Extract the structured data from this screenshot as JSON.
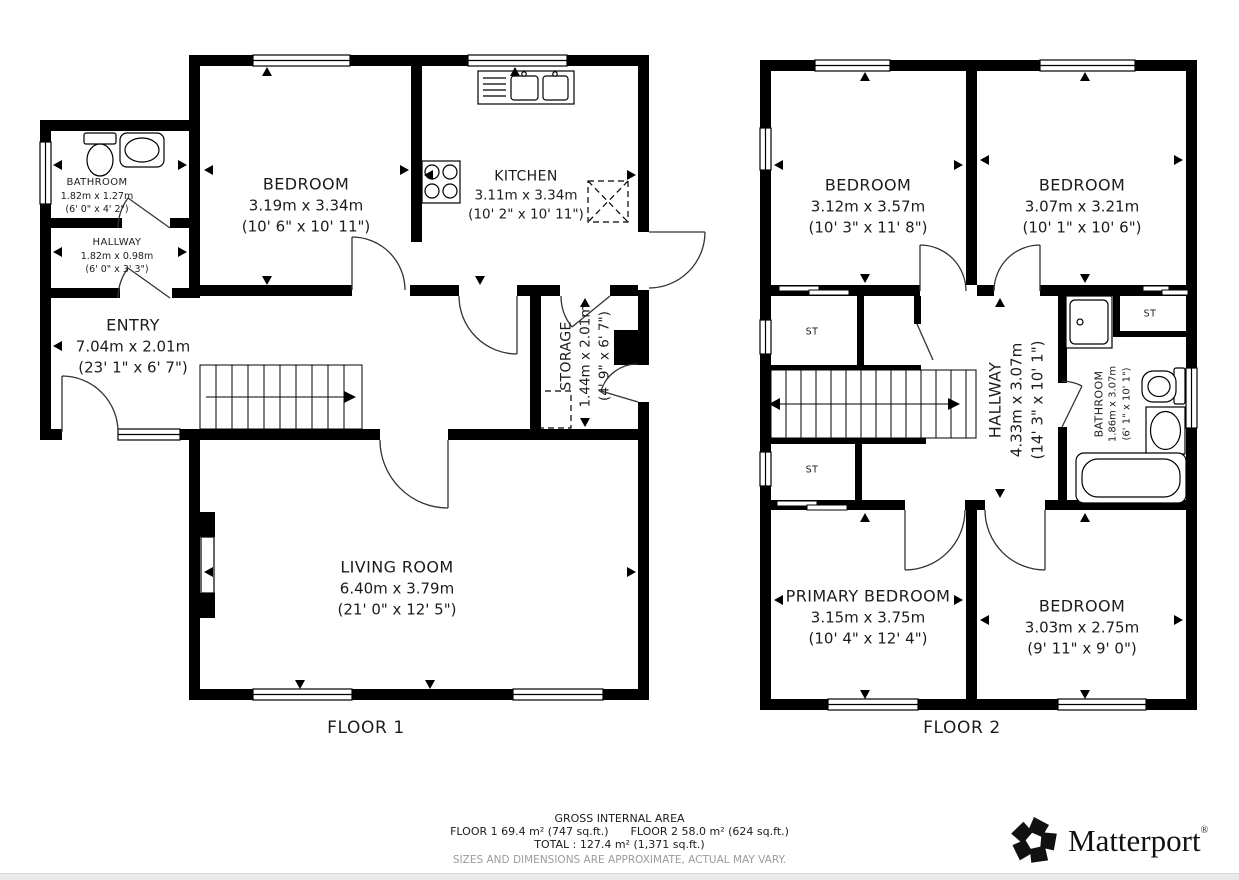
{
  "colors": {
    "wall": "#000000",
    "text": "#1c1c1c",
    "muted_text": "#9b9b9b",
    "footer_bar": "#eaeaea"
  },
  "floor1": {
    "label": "FLOOR 1",
    "rooms": [
      {
        "name": "BATHROOM",
        "metric": "1.82m x 1.27m",
        "imperial": "(6' 0\" x 4' 2\")"
      },
      {
        "name": "HALLWAY",
        "metric": "1.82m x 0.98m",
        "imperial": "(6' 0\" x 3' 3\")"
      },
      {
        "name": "BEDROOM",
        "metric": "3.19m x 3.34m",
        "imperial": "(10' 6\" x 10' 11\")"
      },
      {
        "name": "KITCHEN",
        "metric": "3.11m x 3.34m",
        "imperial": "(10' 2\" x 10' 11\")"
      },
      {
        "name": "ENTRY",
        "metric": "7.04m x 2.01m",
        "imperial": "(23' 1\" x 6' 7\")"
      },
      {
        "name": "STORAGE",
        "metric": "1.44m x 2.01m",
        "imperial": "(4' 9\" x 6' 7\")"
      },
      {
        "name": "LIVING ROOM",
        "metric": "6.40m x 3.79m",
        "imperial": "(21' 0\" x 12' 5\")"
      }
    ]
  },
  "floor2": {
    "label": "FLOOR 2",
    "closet_label": "ST",
    "rooms": [
      {
        "name": "BEDROOM",
        "metric": "3.12m x 3.57m",
        "imperial": "(10' 3\" x 11' 8\")"
      },
      {
        "name": "BEDROOM",
        "metric": "3.07m x 3.21m",
        "imperial": "(10' 1\" x 10' 6\")"
      },
      {
        "name": "HALLWAY",
        "metric": "4.33m x 3.07m",
        "imperial": "(14' 3\" x 10' 1\")"
      },
      {
        "name": "BATHROOM",
        "metric": "1.86m x 3.07m",
        "imperial": "(6' 1\" x 10' 1\")"
      },
      {
        "name": "PRIMARY BEDROOM",
        "metric": "3.15m x 3.75m",
        "imperial": "(10' 4\" x 12' 4\")"
      },
      {
        "name": "BEDROOM",
        "metric": "3.03m x 2.75m",
        "imperial": "(9' 11\" x 9' 0\")"
      }
    ]
  },
  "footer": {
    "gross_title": "GROSS INTERNAL AREA",
    "floor1_area": "FLOOR 1 69.4 m² (747 sq.ft.)",
    "floor2_area": "FLOOR 2 58.0 m² (624 sq.ft.)",
    "total_line": "TOTAL :  127.4 m² (1,371 sq.ft.)",
    "disclaimer": "SIZES AND DIMENSIONS ARE APPROXIMATE, ACTUAL MAY VARY.",
    "brand": "Matterport",
    "brand_registered": "®"
  }
}
